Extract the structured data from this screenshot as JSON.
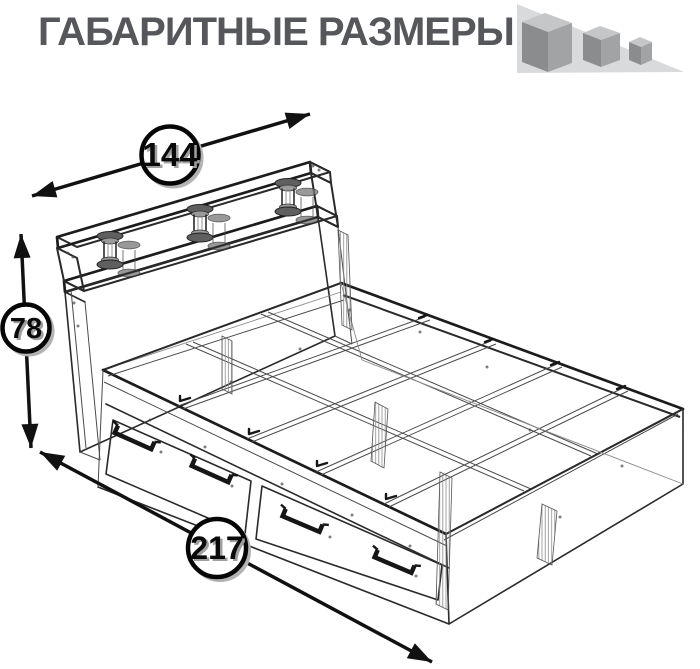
{
  "header": {
    "title": "ГАБАРИТНЫЕ РАЗМЕРЫ"
  },
  "logo": {
    "name": "three-cubes-logo",
    "cube_count": 3
  },
  "dimensions": {
    "width": {
      "value": "144",
      "orientation": "diagonal-top"
    },
    "height": {
      "value": "78",
      "orientation": "vertical-left"
    },
    "length": {
      "value": "217",
      "orientation": "diagonal-bottom"
    }
  },
  "drawing": {
    "subject": "bed with headboard shelf, glass columns and two underbed drawers",
    "style": "transparent wireframe isometric"
  },
  "colors": {
    "background": "#ffffff",
    "title_text": "#56575a",
    "line": "#2a2a2a",
    "dimension_text": "#0a0a0a",
    "dimension_text_shadow": "#a0a0a0",
    "logo_triangle": "#d9dadb",
    "logo_cube_top": "#c5c6c8",
    "logo_cube_left": "#8b8c8e",
    "logo_cube_right": "#a2a3a5"
  }
}
